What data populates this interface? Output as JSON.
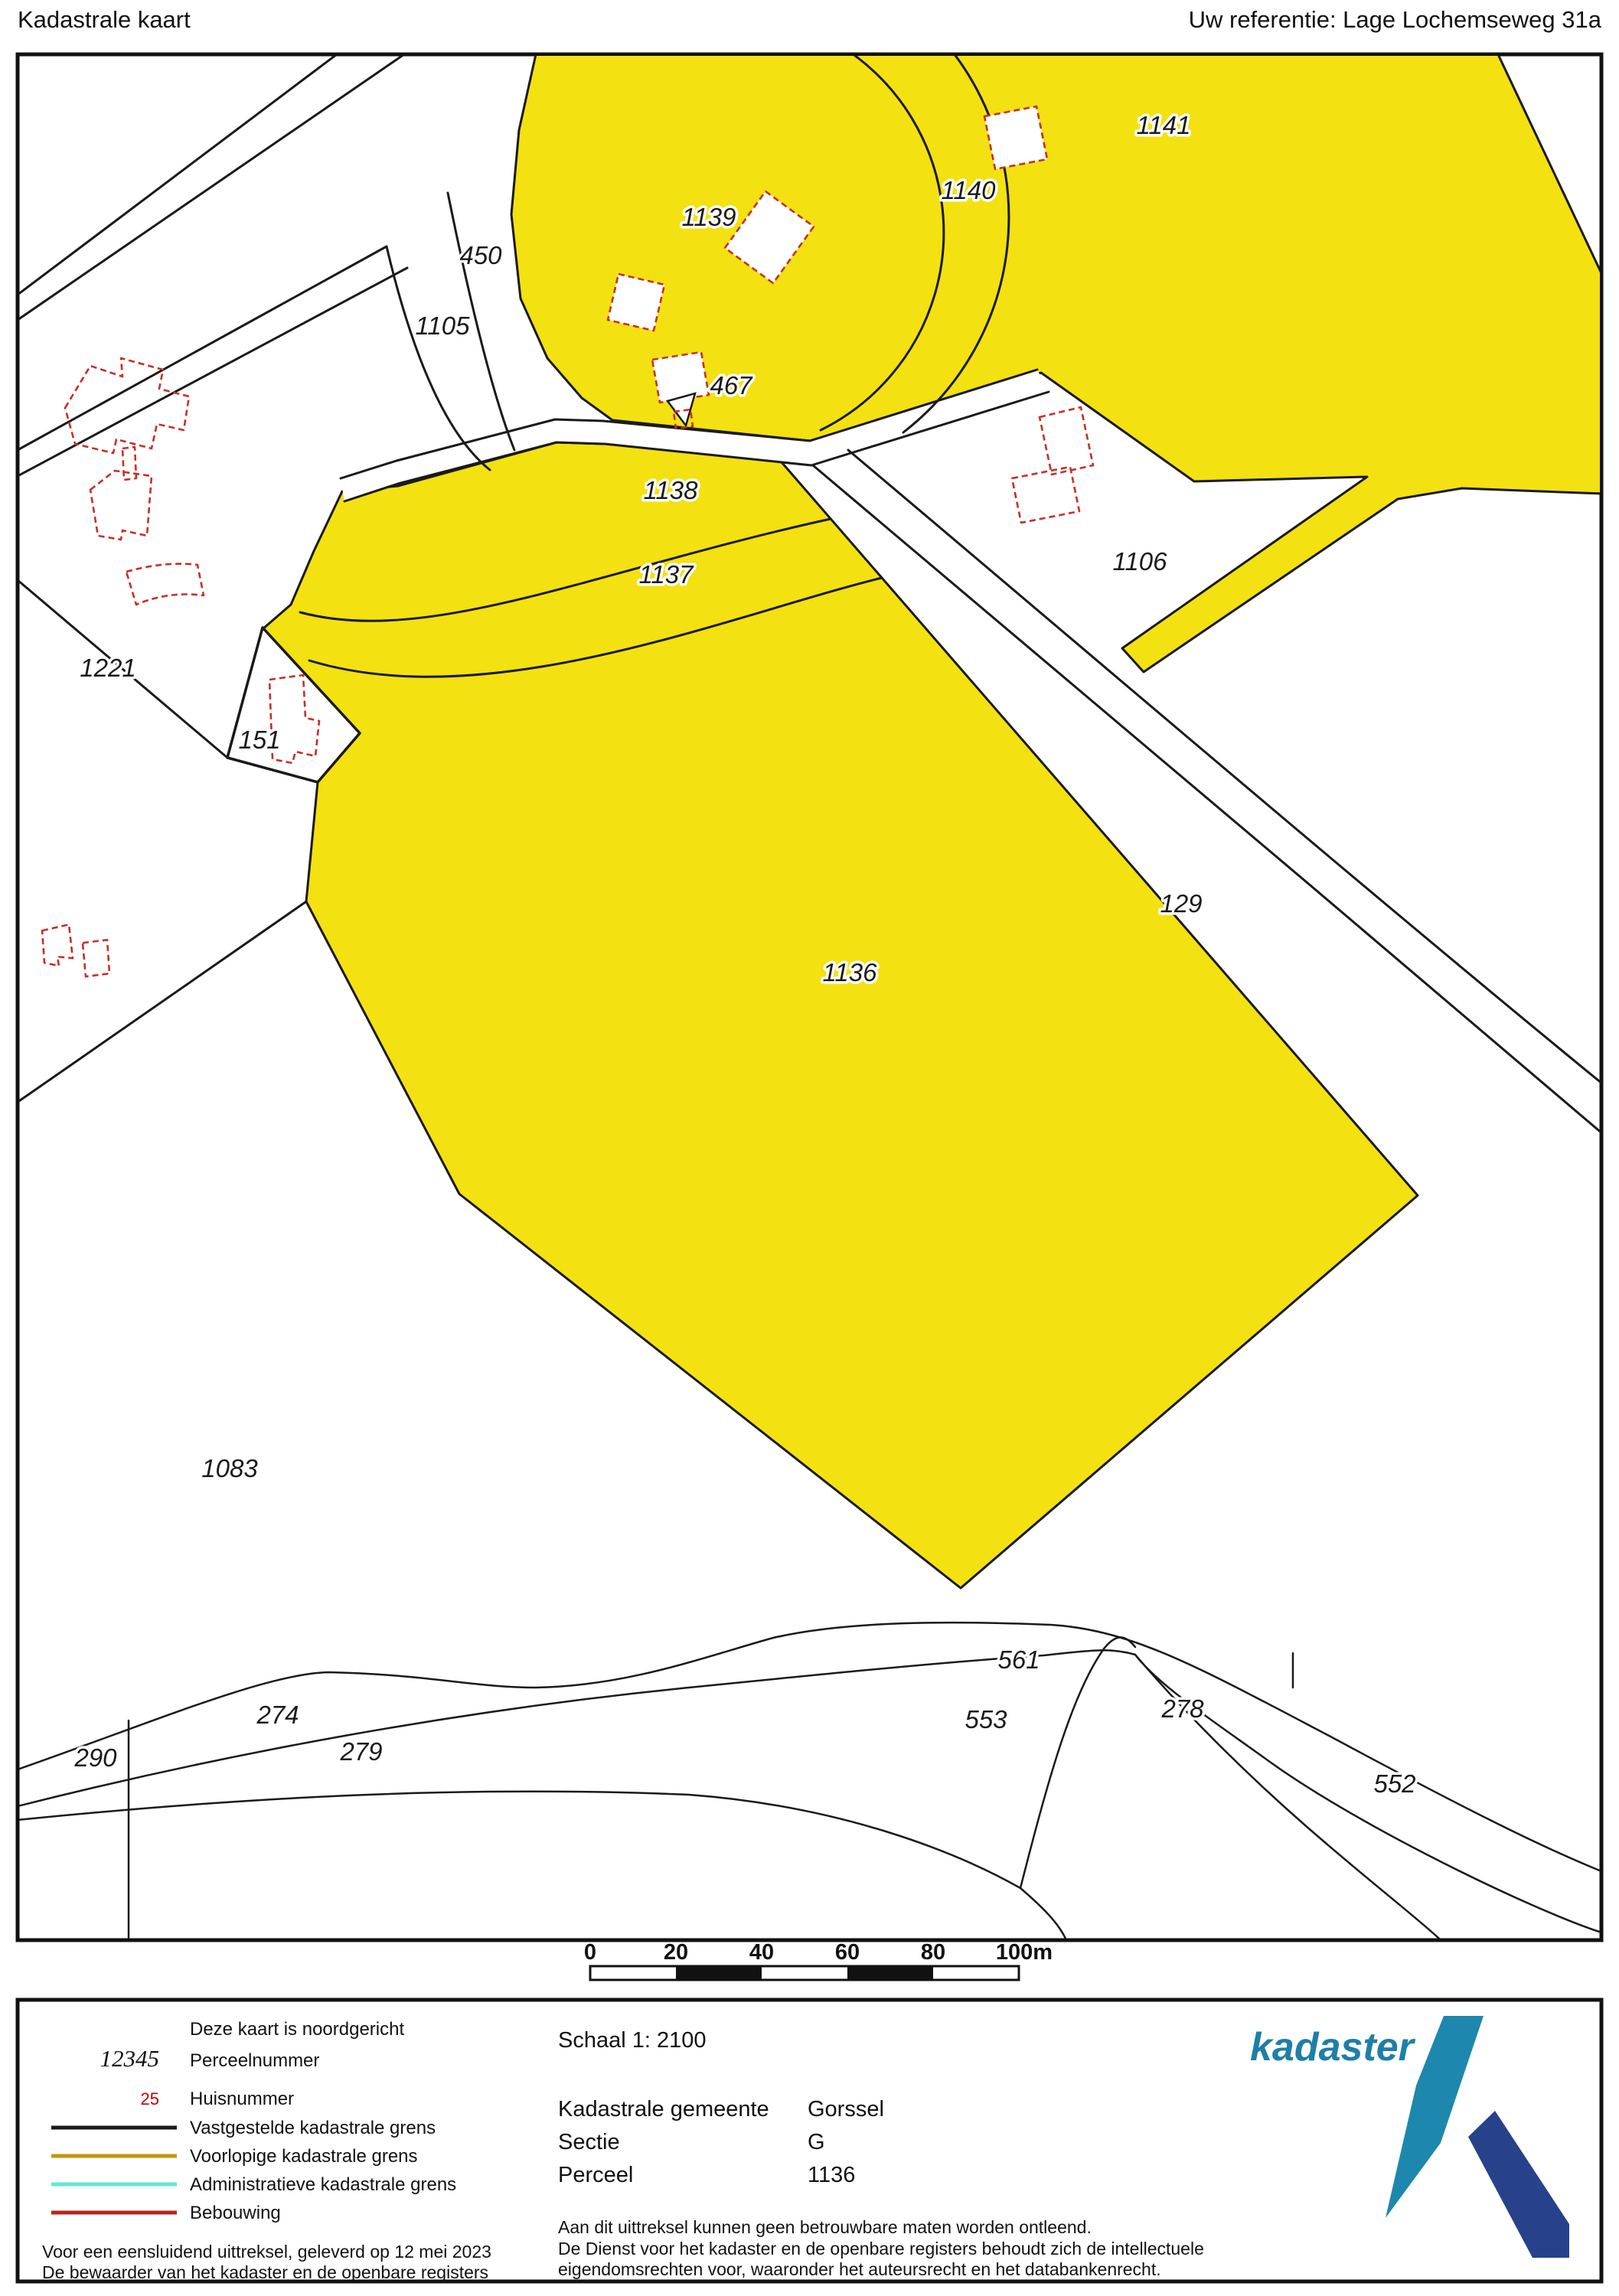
{
  "header": {
    "title": "Kadastrale kaart",
    "reference": "Uw referentie: Lage Lochemseweg 31a"
  },
  "map": {
    "labels": {
      "p1141": "1141",
      "p1140": "1140",
      "p1139": "1139",
      "p450": "450",
      "p1105": "1105",
      "p467": "467",
      "p1138": "1138",
      "p1137": "1137",
      "p1106": "1106",
      "p1221": "1221",
      "p151": "151",
      "p129": "129",
      "p1136": "1136",
      "p1083": "1083",
      "p274": "274",
      "p279": "279",
      "p290": "290",
      "p561": "561",
      "p553": "553",
      "p278": "278",
      "p552": "552"
    },
    "highlight_color": "#f3e111",
    "boundary_color": "#1a1a1a",
    "building_color": "#c63026"
  },
  "scale_bar": {
    "ticks": [
      "0",
      "20",
      "40",
      "60",
      "80"
    ],
    "end_tick": "100m"
  },
  "legend": {
    "north_note": "Deze kaart is noordgericht",
    "perceel_sample": "12345",
    "perceel_label": "Perceelnummer",
    "huis_sample": "25",
    "huis_label": "Huisnummer",
    "line1_label": "Vastgestelde kadastrale grens",
    "line2_label": "Voorlopige kadastrale grens",
    "line3_label": "Administratieve kadastrale grens",
    "line4_label": "Bebouwing",
    "line1_color": "#1a1a1a",
    "line2_color": "#c8940a",
    "line3_color": "#63e6d8",
    "line4_color": "#b6251c"
  },
  "panel": {
    "schaal": "Schaal 1: 2100",
    "gemeente_label": "Kadastrale gemeente",
    "gemeente_value": "Gorssel",
    "sectie_label": "Sectie",
    "sectie_value": "G",
    "perceel_label": "Perceel",
    "perceel_value": "1136",
    "footer_left_1": "Voor een eensluidend uittreksel, geleverd op 12 mei 2023",
    "footer_left_2": "De bewaarder van het kadaster en de openbare registers",
    "disclaimer_1": "Aan dit uittreksel kunnen geen betrouwbare maten worden ontleend.",
    "disclaimer_2": "De Dienst voor het kadaster en de openbare registers behoudt zich de intellectuele",
    "disclaimer_3": "eigendomsrechten voor, waaronder het auteursrecht en het databankenrecht.",
    "logo_text": "kadaster"
  }
}
